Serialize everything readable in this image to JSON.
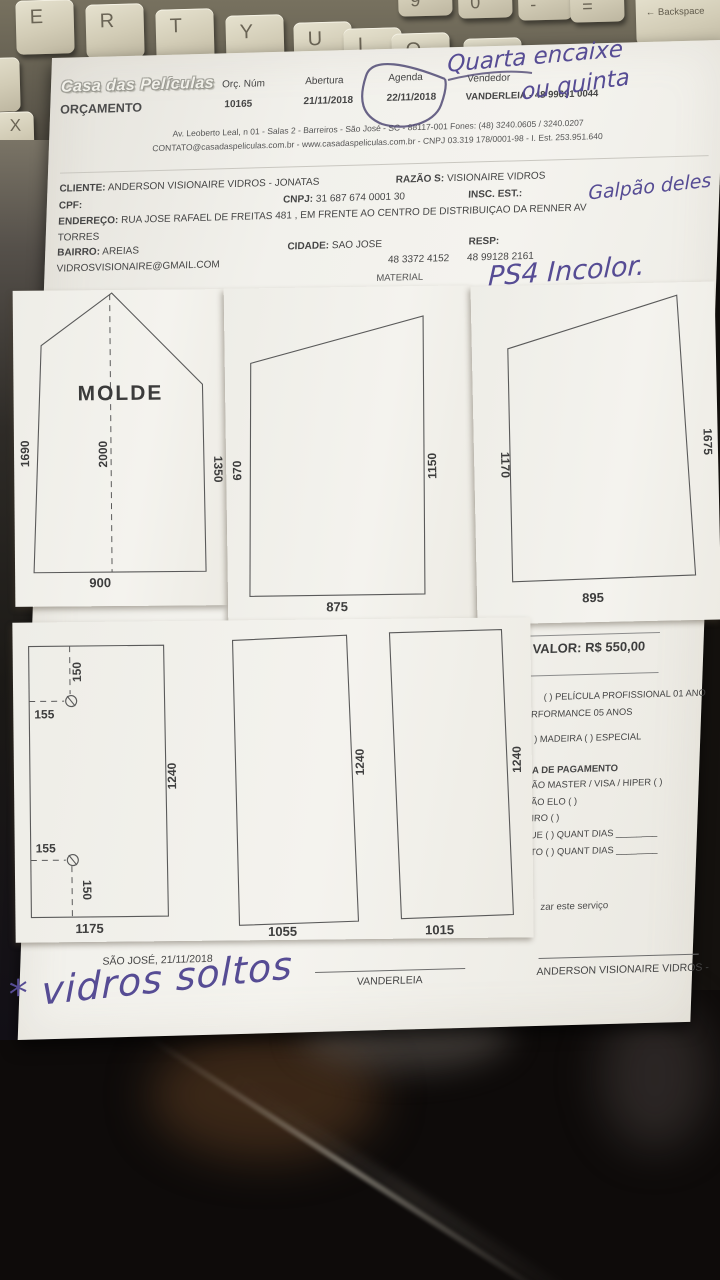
{
  "keyboard": {
    "letters": [
      "E",
      "R",
      "T",
      "Y",
      "U",
      "I",
      "O",
      "P"
    ],
    "numbers": [
      "9",
      "0",
      "-",
      "="
    ],
    "backspace_label": "← Backspace",
    "side_key": "X"
  },
  "header": {
    "logo": "Casa das Películas",
    "doc_type": "ORÇAMENTO",
    "orc_num_label": "Orç. Núm",
    "orc_num": "10165",
    "abertura_label": "Abertura",
    "abertura": "21/11/2018",
    "agenda_label": "Agenda",
    "agenda": "22/11/2018",
    "vendedor_label": "Vendedor",
    "vendedor": "VANDERLEIA - 48 99691 0044",
    "address_line1": "Av. Leoberto Leal, n 01 - Salas 2 - Barreiros - São José - SC - 88117-001 Fones: (48) 3240.0605 / 3240.0207",
    "address_line2": "CONTATO@casadaspeliculas.com.br - www.casadaspeliculas.com.br - CNPJ 03.319 178/0001-98 - I. Est. 253.951.640"
  },
  "handwriting": {
    "note_line1": "Quarta encaixe",
    "note_line2": "ou quinta",
    "insc_note": "Galpão deles",
    "material_note": "PS4 Incolor.",
    "bottom_note": "* vidros soltos",
    "ink_color": "#564c94"
  },
  "client": {
    "cliente_label": "CLIENTE:",
    "cliente": "ANDERSON VISIONAIRE VIDROS - JONATAS",
    "razao_label": "RAZÃO S:",
    "razao": "VISIONAIRE VIDROS",
    "cpf_label": "CPF:",
    "cnpj_label": "CNPJ:",
    "cnpj": "31 687 674 0001 30",
    "insc_label": "INSC. EST.:",
    "endereco_label": "ENDEREÇO:",
    "endereco": "RUA JOSE RAFAEL DE FREITAS 481 , EM FRENTE AO CENTRO DE DISTRIBUIÇAO DA RENNER AV",
    "endereco_cont": "TORRES",
    "bairro_label": "BAIRRO:",
    "bairro": "AREIAS",
    "cidade_label": "CIDADE:",
    "cidade": "SAO JOSE",
    "resp_label": "RESP:",
    "email": "VIDROSVISIONAIRE@GMAIL.COM",
    "phone1": "48 3372 4152",
    "phone2": "48 99128 2161",
    "material_label": "MATERIAL"
  },
  "diagrams": {
    "molde": {
      "title": "MOLDE",
      "left": "1690",
      "center": "2000",
      "right": "1350",
      "bottom": "900"
    },
    "glass2": {
      "left": "670",
      "right": "1150",
      "bottom": "875"
    },
    "glass3": {
      "left": "1170",
      "right": "1675",
      "bottom": "895"
    },
    "rect1": {
      "top_offset": "150",
      "top_inset": "155",
      "bottom_inset": "155",
      "bottom_offset": "150",
      "side": "1240",
      "bottom": "1175"
    },
    "rect2": {
      "side": "1240",
      "bottom": "1055"
    },
    "rect3": {
      "side": "1240",
      "bottom": "1015"
    }
  },
  "pricing": {
    "valor": "VALOR: R$ 550,00",
    "line1": "(  ) PELÍCULA PROFISSIONAL 01 ANO",
    "line2": "RFORMANCE 05 ANOS",
    "line3": ")  MADEIRA   (  )  ESPECIAL",
    "line4": "A DE PAGAMENTO",
    "line5": "ÃO MASTER / VISA / HIPER   (   )",
    "line6": "ÃO ELO   (   )",
    "line7": "IRO   (   )",
    "line8": "UE   (   )   QUANT DIAS ________",
    "line9": "TO   (   )   QUANT DIAS ________",
    "service_note": "zar este serviço"
  },
  "footer": {
    "city_date": "SÃO JOSÉ, 21/11/2018",
    "signature1": "VANDERLEIA",
    "signature2": "ANDERSON VISIONAIRE VIDROS -"
  }
}
